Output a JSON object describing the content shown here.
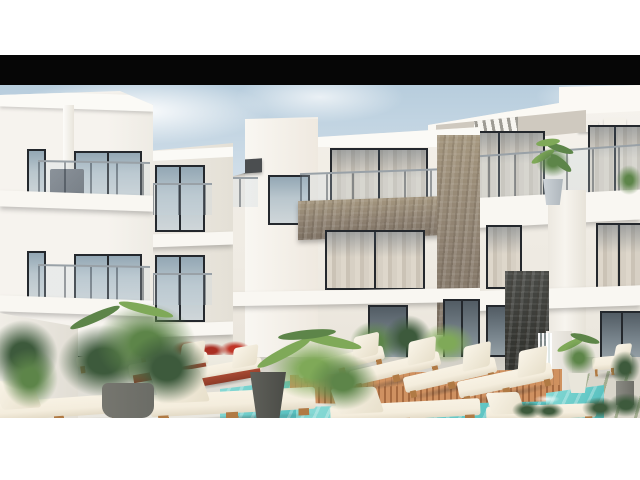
{
  "meta": {
    "type": "architectural exterior rendering",
    "description": "3D architectural rendering of a modern white residential apartment complex with glass-railing balconies, stone accent walls, palm plants, poolside sun loungers on a wooden deck and a turquoise swimming pool, letterboxed with a black bar on a white page."
  },
  "palette": {
    "page_bg": "#ffffff",
    "letterbox_black": "#060606",
    "sky_top": "#b7cddd",
    "sky_bottom": "#eef2f3",
    "building_lit": "#f6f3ee",
    "building_mid": "#efebe3",
    "building_shade": "#e4e0d6",
    "slab_white": "#f9f7f2",
    "window_frame": "#24282d",
    "glass_blue": "#93a7b4",
    "curtain_beige": "#d6cfc3",
    "stone_beige": "#998b7a",
    "stone_dark": "#3e3f3c",
    "awning_dark": "#4b4e50",
    "ground_concrete": "#dedbd3",
    "deck_wood": "#d0915f",
    "deck_wood_gap": "#a66a40",
    "pool_turquoise": "#66c9c7",
    "pool_light": "#8adbd6",
    "coping_white": "#edefe9",
    "paver_light": "#d9d5ca",
    "paver_gap_green": "#a3ad90",
    "cushion_cream": "#f4eddd",
    "lounger_wood": "#b07a44",
    "lounger_red": "#a84a33",
    "plant_dark": "#3d5a3c",
    "plant_mid": "#5d8549",
    "plant_bright": "#7fa958",
    "flower_red": "#c03527",
    "pot_grey": "#6b6c66",
    "pot_white": "#e9e6db"
  }
}
